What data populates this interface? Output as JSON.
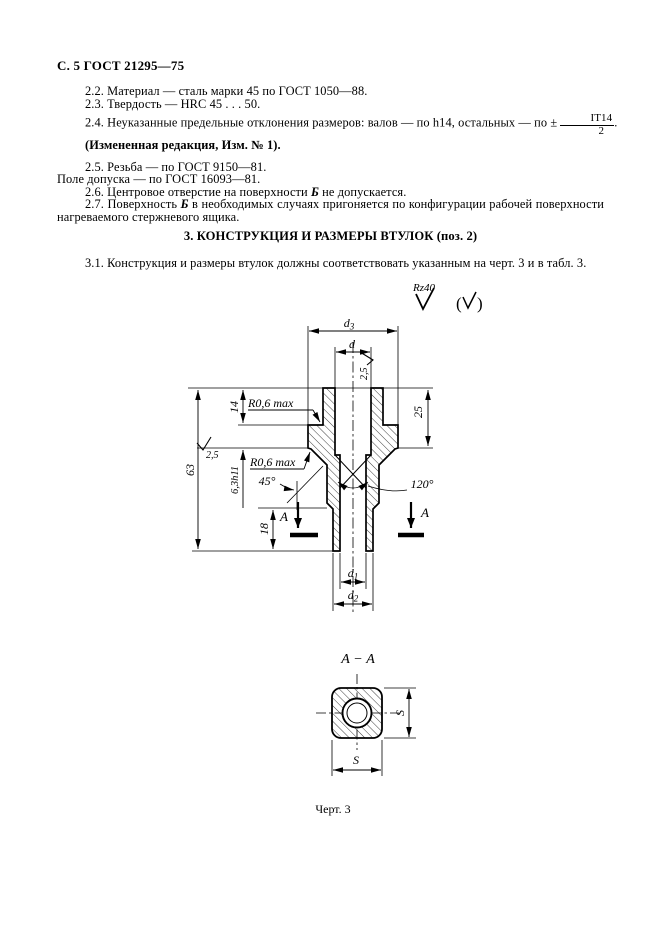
{
  "colors": {
    "page_bg": "#ffffff",
    "ink": "#000000"
  },
  "page": {
    "header": "С. 5 ГОСТ 21295—75",
    "paragraphs": {
      "p22": "2.2. Материал — сталь марки 45 по ГОСТ 1050—88.",
      "p23": "2.3. Твердость — HRC 45 . . . 50.",
      "p24_prefix": "2.4. Неуказанные предельные отклонения размеров: валов — по h14, остальных — по ± ",
      "p24_frac_num": "IT14",
      "p24_frac_den": "2",
      "p24_suffix": ".",
      "p24_note": "(Измененная редакция, Изм. № 1).",
      "p25a": "2.5. Резьба — по ГОСТ 9150—81.",
      "p25b": "Поле допуска — по ГОСТ 16093—81.",
      "p26_prefix": "2.6. Центровое отверстие на поверхности ",
      "p26_b": "Б",
      "p26_suffix": " не допускается.",
      "p27_prefix": "2.7. Поверхность ",
      "p27_b": "Б",
      "p27_suffix": " в необходимых случаях пригоняется по конфигурации рабочей поверхности нагреваемого стержневого ящика.",
      "section3_title": "3. КОНСТРУКЦИЯ И РАЗМЕРЫ ВТУЛОК (поз. 2)",
      "p31": "3.1. Конструкция и размеры втулок должны соответствовать указанным на черт. 3 и в табл. 3."
    }
  },
  "drawing": {
    "roughness_general": "Rz40",
    "dims": {
      "d3_base": "d",
      "d3_sub": "3",
      "d": "d",
      "rough_top": "2,5",
      "rough_left": "2,5",
      "h63": "63",
      "h14": "14",
      "flange": "6,3h11",
      "r06_top": "R0,6 max",
      "r06_bottom": "R0,6 max",
      "ang45": "45°",
      "ang120": "120°",
      "h25": "25",
      "h18": "18",
      "secA_left": "А",
      "secA_right": "А",
      "d1_base": "d",
      "d1_sub": "1",
      "d2_base": "d",
      "d2_sub": "2"
    },
    "section_view": {
      "title": "А − А",
      "s_right": "S",
      "s_bottom": "S"
    },
    "caption": "Черт. 3"
  }
}
